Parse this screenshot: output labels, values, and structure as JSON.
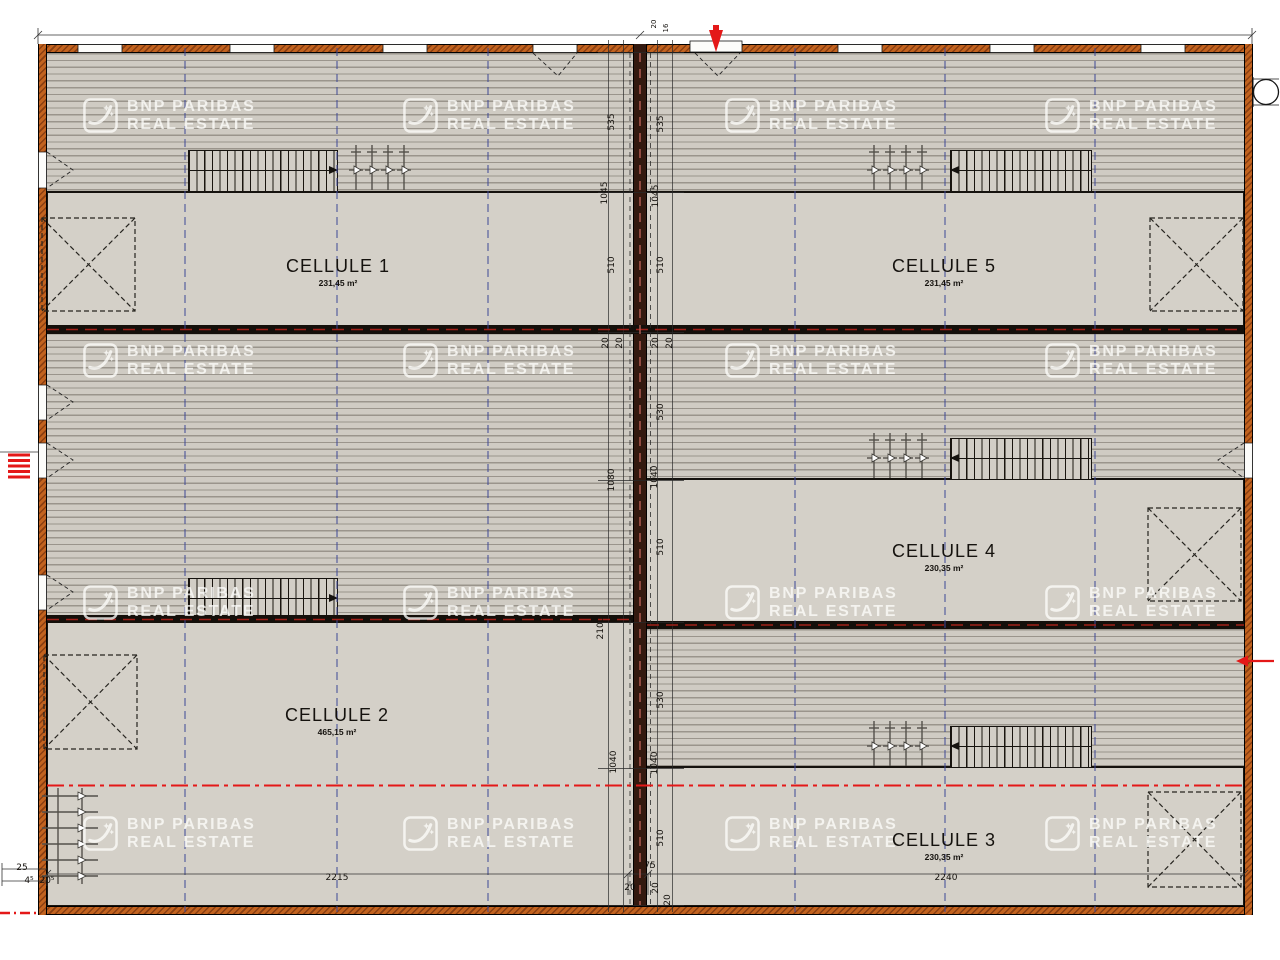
{
  "watermark": {
    "line1": "BNP PARIBAS",
    "line2": "REAL ESTATE"
  },
  "rooms": {
    "cellule1": {
      "name": "CELLULE 1",
      "area": "231,45 m²"
    },
    "cellule2": {
      "name": "CELLULE 2",
      "area": "465,15 m²"
    },
    "cellule3": {
      "name": "CELLULE 3",
      "area": "230,35 m²"
    },
    "cellule4": {
      "name": "CELLULE 4",
      "area": "230,35 m²"
    },
    "cellule5": {
      "name": "CELLULE 5",
      "area": "231,45 m²"
    }
  },
  "dims": {
    "items": [
      "2215",
      "2240",
      "20",
      "75",
      "25",
      "4⁵",
      "20⁵",
      "535",
      "1045",
      "510",
      "535",
      "1045",
      "510",
      "20",
      "20",
      "1080",
      "2100",
      "20",
      "20",
      "530",
      "1040",
      "510",
      "1040",
      "530",
      "1040",
      "510",
      "20",
      "20",
      "20",
      "16"
    ]
  },
  "colors": {
    "wall_orange": "#bf5e1e",
    "plan_fill": "#d4d0c8",
    "hatch_line": "#aaa49a",
    "grid_blue": "#3d4796",
    "fire_red": "#e41818",
    "line_black": "#1a150f"
  }
}
